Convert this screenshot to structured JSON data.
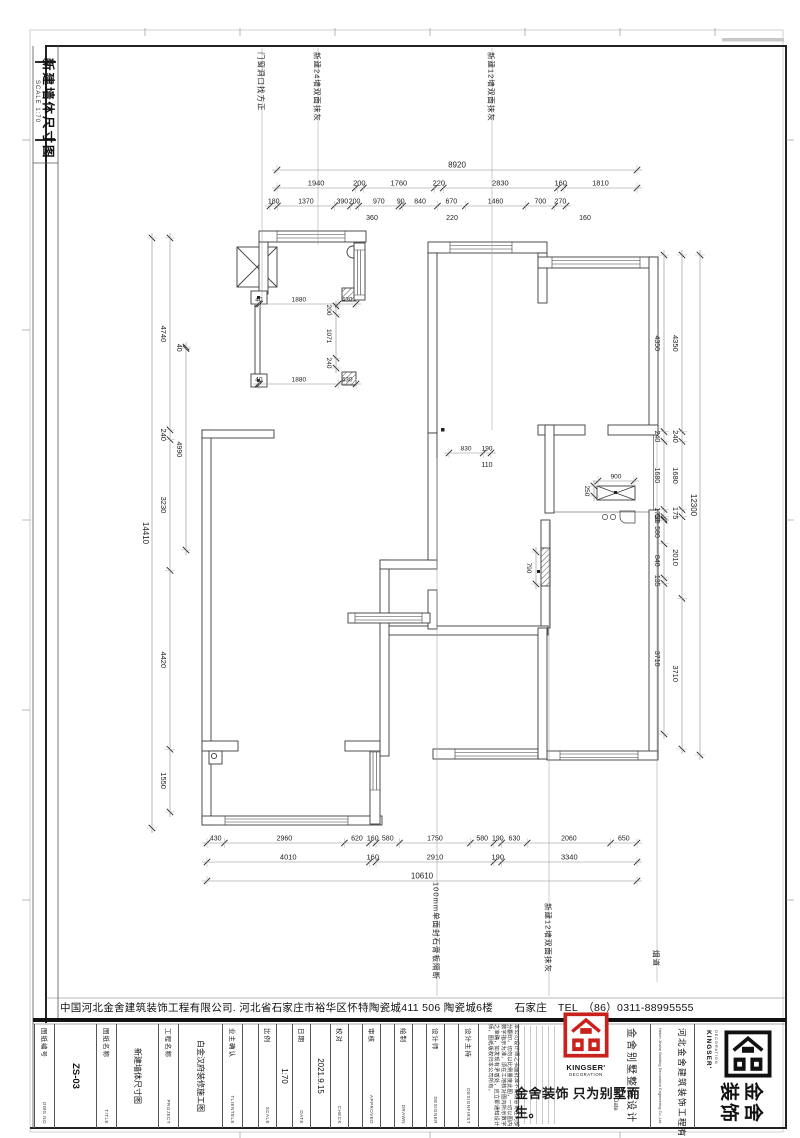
{
  "sheet": {
    "title": "新建墙体尺寸图",
    "scale_note": "SCALE 1:70",
    "company_bar": "中国河北金舍建筑装饰工程有限公司. 河北省石家庄市裕华区怀特陶瓷城411 506 陶瓷城6楼　　石家庄　TEL　（86）0311-88995555"
  },
  "annotations": [
    {
      "text": "门窗洞口找方正",
      "x": 262,
      "ty": 52,
      "y1": 48,
      "y2": 300
    },
    {
      "text": "新建24墙双面抹灰",
      "x": 318,
      "ty": 52,
      "y1": 48,
      "y2": 245
    },
    {
      "text": "新建12墙双面抹灰",
      "x": 492,
      "ty": 52,
      "y1": 48,
      "y2": 430
    },
    {
      "text": "100mm单面封石膏板隔断",
      "x": 437,
      "ty": 882,
      "y1": 458,
      "y2": 996
    },
    {
      "text": "新建12墙双面抹灰",
      "x": 549,
      "ty": 903,
      "y1": 522,
      "y2": 996
    },
    {
      "text": "烟道",
      "x": 657,
      "ty": 950,
      "y1": 437,
      "y2": 982
    }
  ],
  "dim_chains": [
    {
      "id": "top-overall",
      "orient": "h",
      "pos": 170,
      "from": 277,
      "to": 637,
      "fs": 8,
      "values": [
        8920
      ]
    },
    {
      "id": "top-major",
      "orient": "h",
      "pos": 188,
      "from": 277,
      "to": 637,
      "fs": 7.5,
      "values": [
        1940,
        200,
        1760,
        220,
        2830,
        160,
        1810
      ]
    },
    {
      "id": "top-minor",
      "orient": "h",
      "pos": 206,
      "from": 270,
      "to": 566,
      "fs": 7,
      "values": [
        180,
        1370,
        390,
        200,
        970,
        90,
        840,
        670,
        1460,
        700,
        270
      ]
    },
    {
      "id": "left-overall",
      "orient": "v",
      "pos": 152,
      "from": 238,
      "to": 828,
      "fs": 8,
      "values": [
        14410
      ]
    },
    {
      "id": "left-major",
      "orient": "v",
      "pos": 170,
      "from": 238,
      "to": 812,
      "fs": 7.5,
      "values": [
        4740,
        240,
        3230,
        4420,
        1550
      ]
    },
    {
      "id": "left-minor",
      "orient": "v",
      "pos": 186,
      "from": 347,
      "to": 550,
      "fs": 7,
      "values": [
        40,
        4990
      ]
    },
    {
      "id": "right-minor",
      "orient": "v",
      "pos": 664,
      "from": 255,
      "to": 734,
      "fs": 7,
      "values": [
        4350,
        240,
        1680,
        175,
        60,
        30,
        580,
        840,
        135,
        3710
      ]
    },
    {
      "id": "right-major",
      "orient": "v",
      "pos": 682,
      "from": 255,
      "to": 749,
      "fs": 7.5,
      "values": [
        4350,
        240,
        1680,
        175,
        2010,
        3710
      ]
    },
    {
      "id": "right-overall",
      "orient": "v",
      "pos": 700,
      "from": 255,
      "to": 755,
      "fs": 8,
      "values": [
        12300
      ]
    },
    {
      "id": "bottom-minor",
      "orient": "h",
      "pos": 843,
      "from": 207,
      "to": 637,
      "fs": 7,
      "values": [
        430,
        2960,
        620,
        160,
        580,
        1750,
        580,
        190,
        630,
        2060,
        650
      ]
    },
    {
      "id": "bottom-major",
      "orient": "h",
      "pos": 862,
      "from": 207,
      "to": 637,
      "fs": 7.5,
      "values": [
        4010,
        160,
        2910,
        190,
        3340
      ]
    },
    {
      "id": "bottom-overall",
      "orient": "h",
      "pos": 881,
      "from": 207,
      "to": 637,
      "fs": 8,
      "values": [
        10610
      ]
    },
    {
      "id": "int-closet-top",
      "orient": "h",
      "pos": 304,
      "from": 258,
      "to": 356,
      "fs": 6.5,
      "values": [
        40,
        1880,
        430
      ]
    },
    {
      "id": "int-closet-bot",
      "orient": "h",
      "pos": 384,
      "from": 258,
      "to": 356,
      "fs": 6.5,
      "values": [
        40,
        1880,
        430
      ]
    },
    {
      "id": "int-closet-v",
      "orient": "v",
      "pos": 336,
      "from": 306,
      "to": 368,
      "fs": 6.5,
      "values": [
        200,
        1071,
        240
      ]
    },
    {
      "id": "int-door",
      "orient": "h",
      "pos": 453,
      "from": 449,
      "to": 491,
      "fs": 6.5,
      "values": [
        830,
        190
      ]
    },
    {
      "id": "int-cab",
      "orient": "h",
      "pos": 481,
      "from": 598,
      "to": 634,
      "fs": 6.5,
      "values": [
        900
      ]
    },
    {
      "id": "int-cab-v",
      "orient": "v",
      "pos": 594,
      "from": 486,
      "to": 496,
      "fs": 6.5,
      "values": [
        250
      ]
    },
    {
      "id": "int-wall-v",
      "orient": "v",
      "pos": 536,
      "from": 552,
      "to": 584,
      "fs": 6.5,
      "values": [
        790
      ]
    }
  ],
  "extra_dims": [
    {
      "text": "360",
      "x": 372,
      "y": 220
    },
    {
      "text": "220",
      "x": 452,
      "y": 220
    },
    {
      "text": "160",
      "x": 585,
      "y": 220
    },
    {
      "text": "110",
      "x": 487,
      "y": 467
    }
  ],
  "title_block": {
    "fields": [
      {
        "label": "图纸编号",
        "en": "DWG NO",
        "value": "ZS-03",
        "lw": 20,
        "vw": 42,
        "big": true
      },
      {
        "label": "图纸名称",
        "en": "TITLE",
        "value": "新建墙体尺寸图",
        "lw": 20,
        "vw": 42,
        "big": false
      },
      {
        "label": "工程名称",
        "en": "PROJECT",
        "value": "白金汉府装修施工图",
        "lw": 20,
        "vw": 44,
        "big": false
      },
      {
        "label": "业主确认",
        "en": "TLIENTELE",
        "value": "",
        "lw": 20,
        "vw": 16,
        "big": false
      },
      {
        "label": "比例",
        "en": "SCALE",
        "value": "1:70",
        "lw": 18,
        "vw": 16,
        "big": false
      },
      {
        "label": "日期",
        "en": "DATE",
        "value": "2021.9.15",
        "lw": 18,
        "vw": 20,
        "big": false
      },
      {
        "label": "校对",
        "en": "CHECK",
        "value": "",
        "lw": 18,
        "vw": 14,
        "big": false
      },
      {
        "label": "审核",
        "en": "APPROVED",
        "value": "",
        "lw": 18,
        "vw": 14,
        "big": false
      },
      {
        "label": "绘制",
        "en": "DRAWN",
        "value": "",
        "lw": 18,
        "vw": 14,
        "big": false
      },
      {
        "label": "设计师",
        "en": "DESIGNER",
        "value": "",
        "lw": 18,
        "vw": 14,
        "big": false
      },
      {
        "label": "设计主持",
        "en": "DESIGNFIRST",
        "value": "",
        "lw": 20,
        "vw": 0,
        "big": false
      }
    ],
    "disclaimer": "本公司设计师之书面批准不得随意将任何部分翻印。切勿以比例量度此图，一切以图内数字指示为准。须在工地核对图内所示数字之准确，如发现有矛盾处，应立即通知设计师，图纸版权归本公司所有。",
    "brand": {
      "logo_name": "KINGSER'",
      "logo_sub": "DECORATION",
      "slogan": "金舍装饰 只为别墅而生。",
      "date_label": "Date",
      "service_vertical": "金舍别墅整装设计",
      "company_vertical": "河北金舍建筑装饰工程有限公司",
      "company_en": "Hebei Jinshe Building Decoration Engineering Co.,Ltd",
      "brand_char_1": "金舍",
      "brand_char_2": "装饰",
      "red": "#c9221c"
    }
  }
}
